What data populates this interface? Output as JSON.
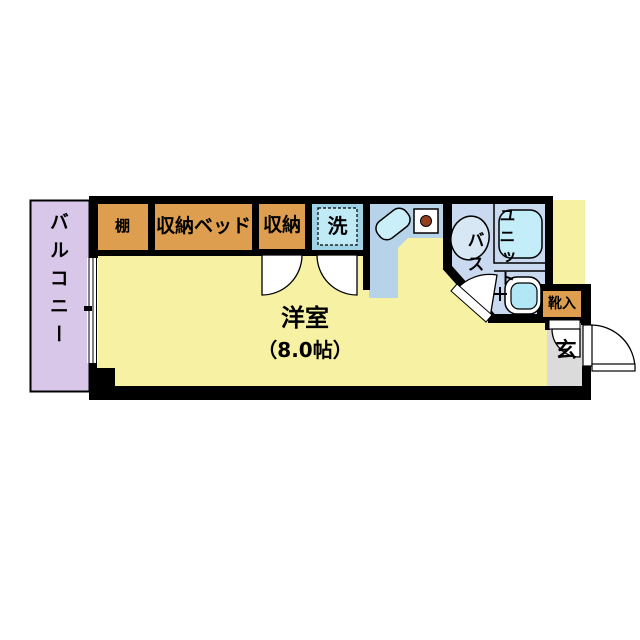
{
  "plan": {
    "balcony": "バルコニー",
    "shelf": "棚",
    "storage_bed": "収納ベッド",
    "storage": "収納",
    "washer": "洗",
    "room_name": "洋室",
    "room_size": "（8.0帖）",
    "unit_bath_col_right": "ユニット",
    "unit_bath_col_left": "バス",
    "shoe_box": "靴入",
    "entrance": "玄"
  },
  "colors": {
    "wall": "#000000",
    "room": "#F6F1A3",
    "balcony": "#D8C7E9",
    "closet": "#DE9E4F",
    "kitchen": "#B7D3EA",
    "bath": "#C9D9F0",
    "genkan": "#DBDBDB",
    "washer_outer": "#9FD2E4",
    "washer_inner": "#BFEAF6",
    "tub": "#C3EDF8",
    "sink": "#CBEFF8",
    "basin": "#D7E7F3",
    "toilet_tank": "#B2E7F5",
    "stove_burner": "#93401F",
    "door_leaf": "#FFFFFF"
  }
}
